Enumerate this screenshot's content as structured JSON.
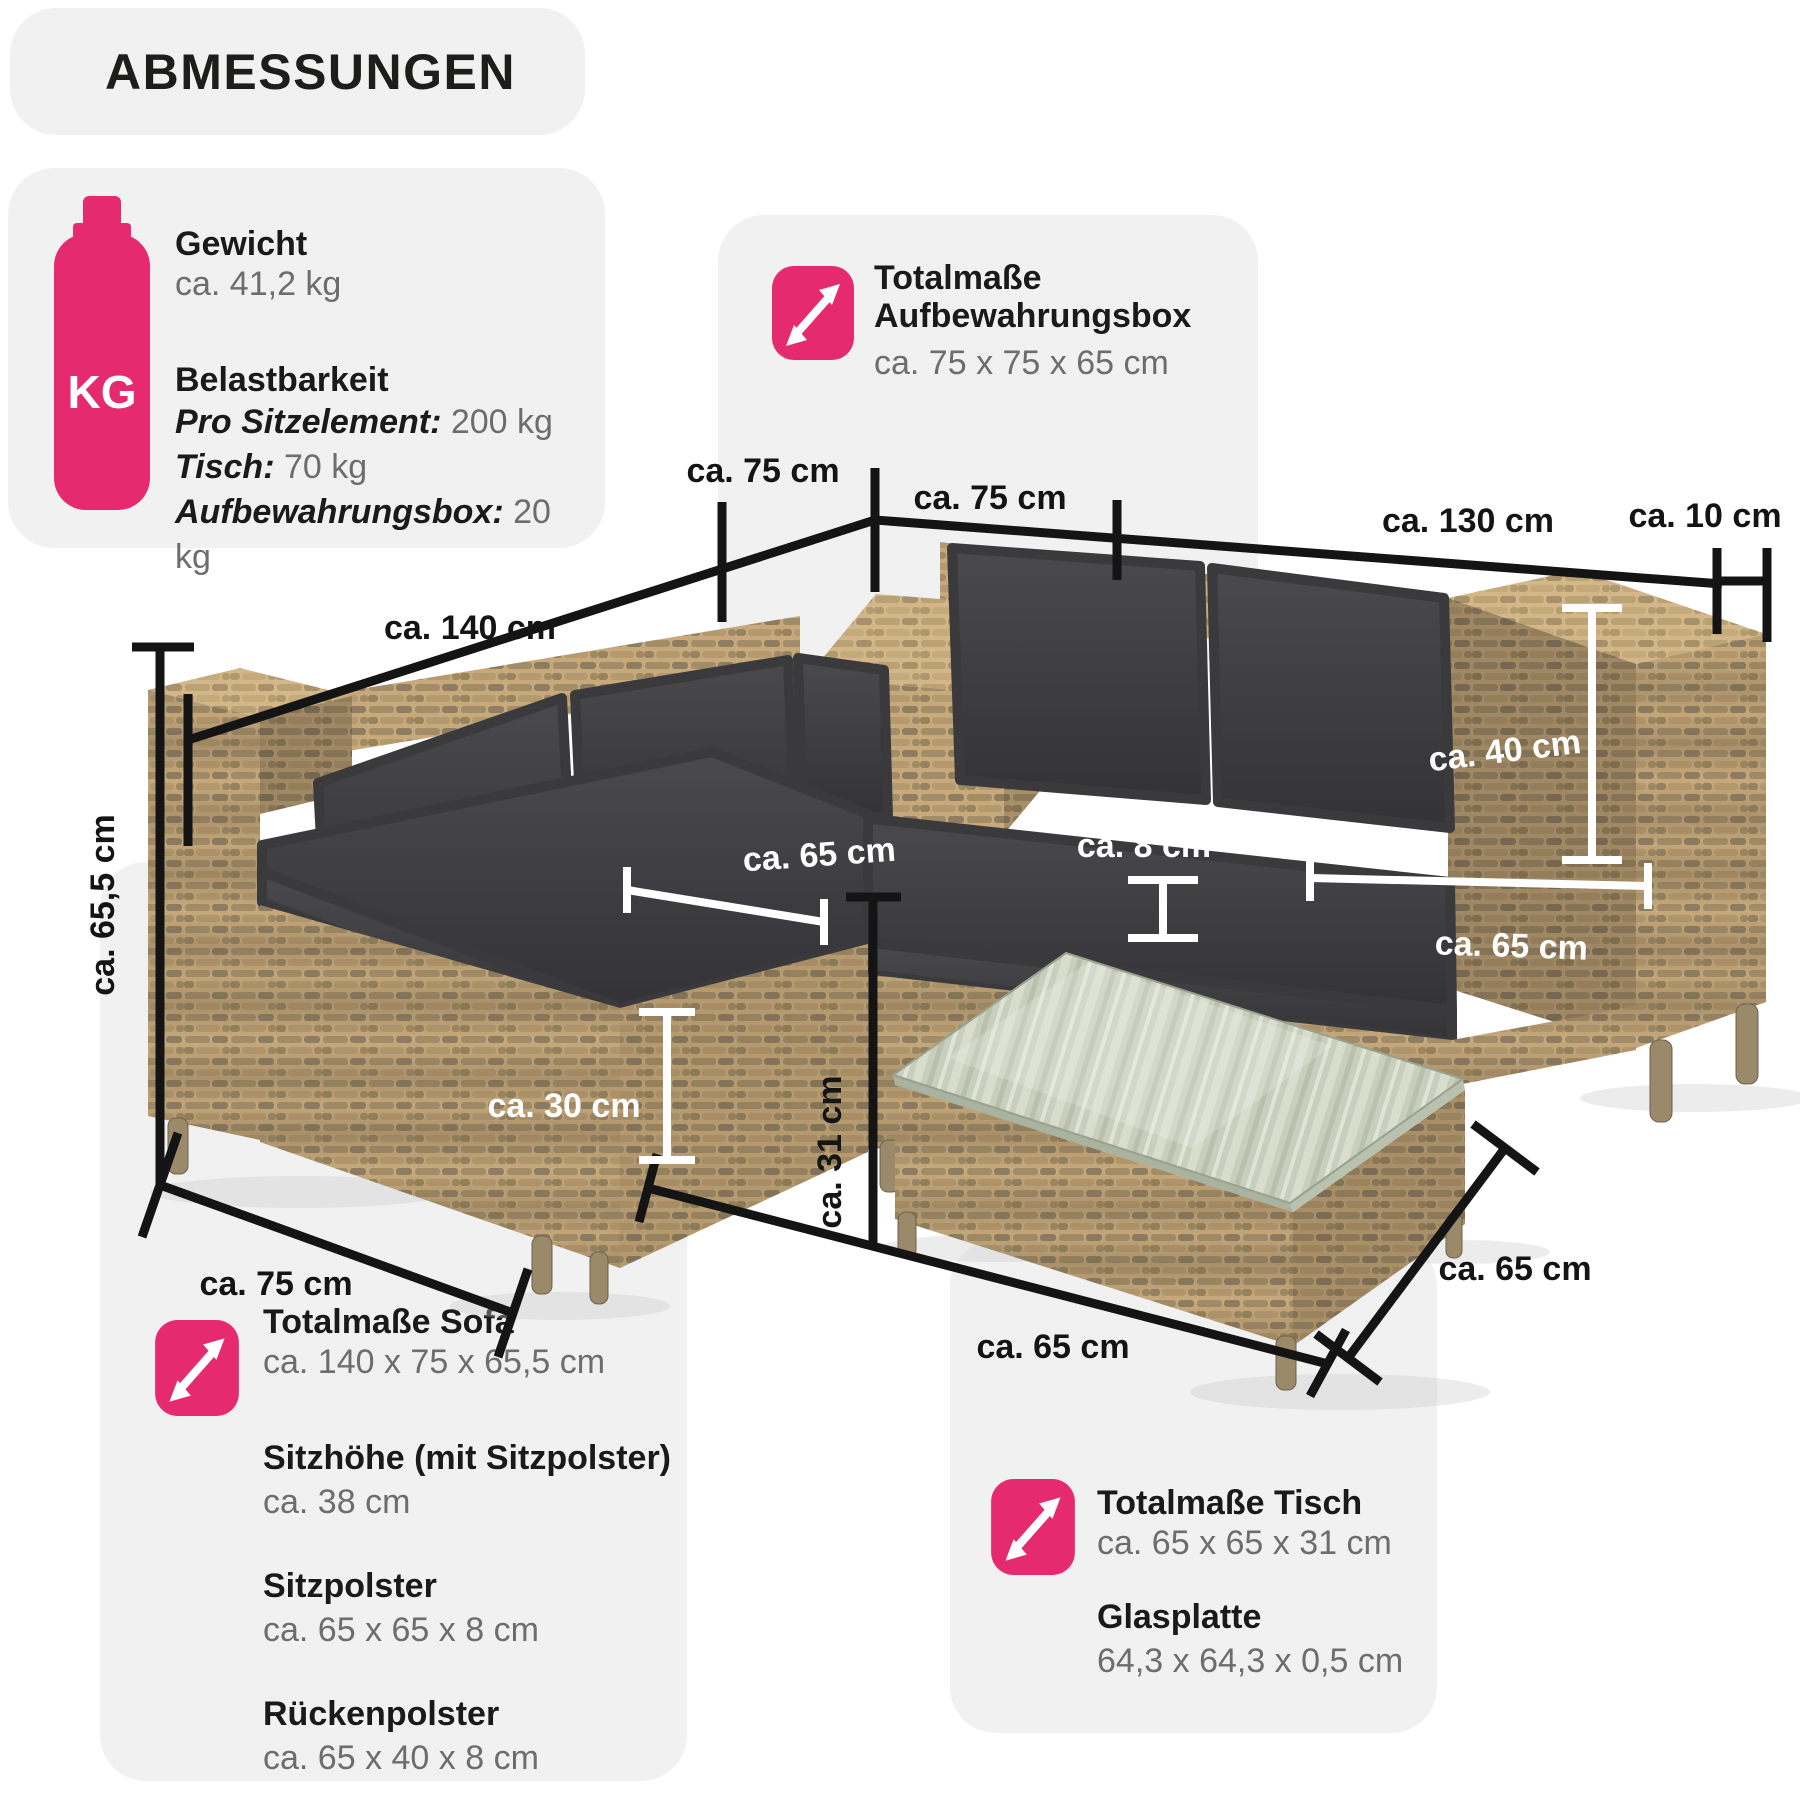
{
  "colors": {
    "pink": "#e52a6f",
    "panel_gray": "#f1f1f2",
    "text_dark": "#1a1a1a",
    "text_gray": "#6d6d6d",
    "line_black": "#141414",
    "annotation_white": "#ffffff",
    "rattan": "#c7a97c",
    "cushion": "#3c3c3e"
  },
  "header": {
    "title": "ABMESSUNGEN"
  },
  "weight_panel": {
    "icon_label": "KG",
    "weight_title": "Gewicht",
    "weight_value": "ca. 41,2 kg",
    "load_title": "Belastbarkeit",
    "load_rows": [
      {
        "label": "Pro Sitzelement:",
        "value": "200 kg"
      },
      {
        "label": "Tisch:",
        "value": "70 kg"
      },
      {
        "label": "Aufbewahrungsbox:",
        "value": "20 kg"
      }
    ]
  },
  "storage_panel": {
    "title_line1": "Totalmaße",
    "title_line2": "Aufbewahrungsbox",
    "value": "ca. 75 x 75 x 65 cm"
  },
  "sofa_panel": {
    "title": "Totalmaße Sofa",
    "value": "ca. 140 x 75 x 65,5 cm",
    "details": [
      {
        "label": "Sitzhöhe (mit Sitzpolster)",
        "value": "ca. 38 cm"
      },
      {
        "label": "Sitzpolster",
        "value": "ca. 65 x 65 x 8 cm"
      },
      {
        "label": "Rückenpolster",
        "value": "ca. 65 x 40 x 8 cm"
      }
    ]
  },
  "table_panel": {
    "title": "Totalmaße Tisch",
    "value": "ca. 65 x 65 x 31 cm",
    "glass_title": "Glasplatte",
    "glass_value": "64,3 x 64,3 x 0,5 cm"
  },
  "dimensions": {
    "box_left": "ca. 75 cm",
    "box_front": "ca. 75 cm",
    "right_length": "ca. 130 cm",
    "arm_width": "ca. 10 cm",
    "left_length": "ca. 140 cm",
    "total_height": "ca. 65,5 cm",
    "sofa_depth": "ca. 75 cm",
    "table_height": "ca. 31 cm",
    "table_front": "ca. 65 cm",
    "table_side": "ca. 65 cm"
  },
  "annotations": {
    "seat_width_left": "ca. 65 cm",
    "cushion_thickness": "ca. 8 cm",
    "back_cushion_height": "ca. 40 cm",
    "seat_width_right": "ca. 65 cm",
    "base_height": "ca. 30 cm"
  }
}
